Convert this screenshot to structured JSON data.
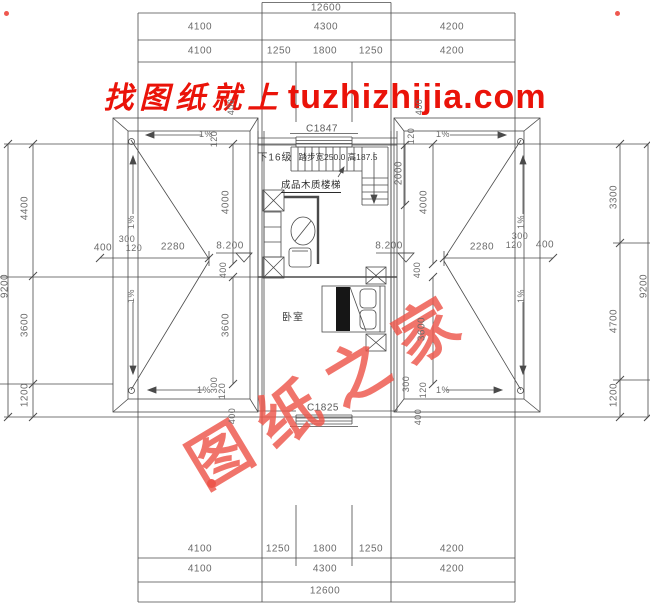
{
  "watermark": {
    "cn": "找图纸就上",
    "site": "tuzhizhijia.com"
  },
  "stamp": {
    "chars": [
      "图",
      "纸",
      "之",
      "家"
    ]
  },
  "top_dims": {
    "total": "12600",
    "row2": [
      "4100",
      "4300",
      "4200"
    ],
    "row3": [
      "4100",
      "1250",
      "1800",
      "1250",
      "4200"
    ]
  },
  "bottom_dims": {
    "row1": [
      "4100",
      "1250",
      "1800",
      "1250",
      "4200"
    ],
    "row2": [
      "4100",
      "4300",
      "4200"
    ],
    "total": "12600"
  },
  "left_dims": {
    "overall": "9200",
    "segments": [
      "4400",
      "3600",
      "1200"
    ]
  },
  "right_dims": {
    "overall": "9200",
    "segments": [
      "3300",
      "4700",
      "1200"
    ]
  },
  "plan": {
    "window_top": "C1847",
    "window_bottom": "C1825",
    "stair_steps": "下16级",
    "stair_spec": "踏步宽250.0 高187.5",
    "stair_note": "成品木质楼梯",
    "bedroom": "卧室",
    "elevation": "8.200",
    "slope": "1%",
    "dim_2280": "2280",
    "dim_2000": "2000",
    "dim_4000": "4000",
    "dim_3600": "3600",
    "dim_400": "400",
    "dim_300": "300",
    "dim_120": "120"
  },
  "colors": {
    "title_red": "#ea1309",
    "stamp_red": "#ed554b",
    "line": "#4a4a4a",
    "text": "#6b6b6b"
  }
}
